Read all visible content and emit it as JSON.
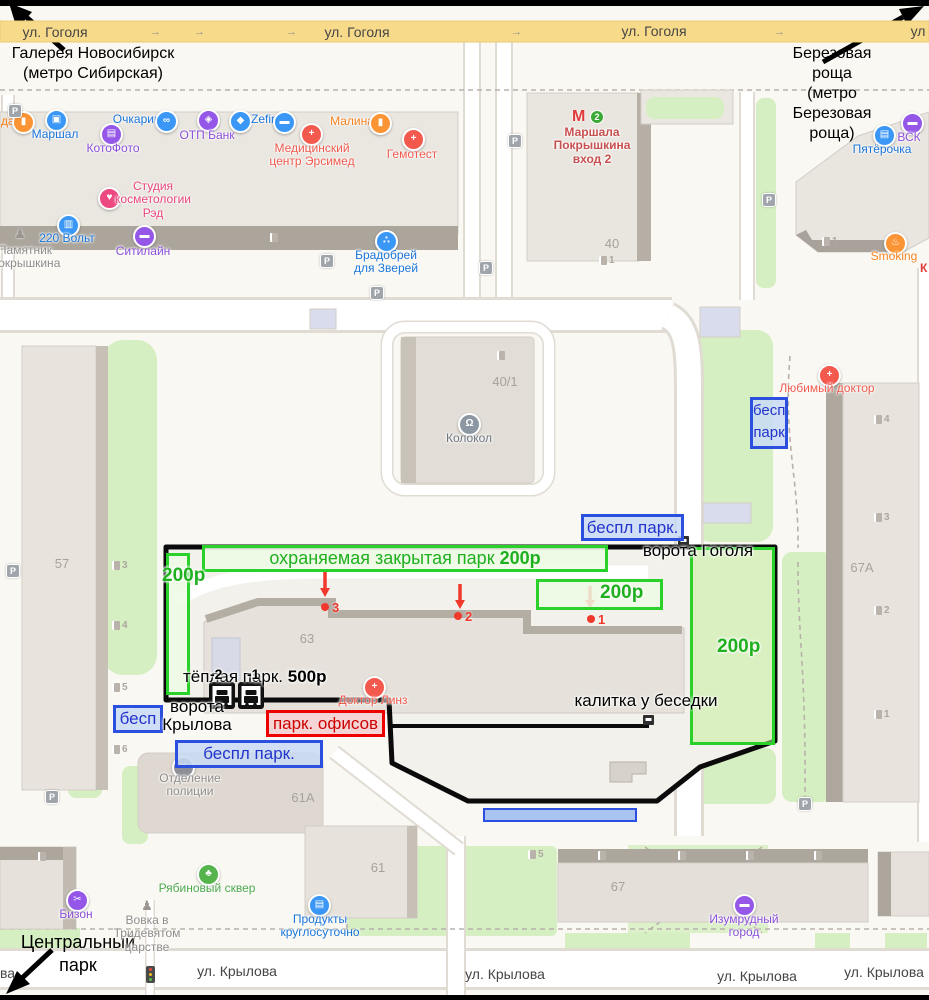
{
  "nav": {
    "top_left": "Галерея Новосибирск\n(метро Сибирская)",
    "top_right": "Березовая роща\n(метро Березовая роща)",
    "bottom_left": "Центральный\nпарк"
  },
  "streets": {
    "gogolya": "ул. Гоголя",
    "gogolya_short": "ул",
    "krylova": "ул. Крылова",
    "krylova_frag": "ва",
    "arrow": "→"
  },
  "parking": {
    "guarded_label": "охраняемая закрытая парк ",
    "guarded_price": "200р",
    "p200": "200р",
    "warm_label": "тёплая парк. ",
    "warm_price": "500р",
    "level_minus2": "-2",
    "level_minus1": "-1",
    "free_short": "бесп",
    "free_two": "бесп\nпарк",
    "free_full": "беспл парк.",
    "office": "парк. офисов"
  },
  "gates": {
    "gogolya": "ворота Гоголя",
    "krylova": "ворота\nКрылова",
    "wicket": "калитка у беседки"
  },
  "markers": {
    "m1": "1",
    "m2": "2",
    "m3": "3"
  },
  "entr": {
    "n1": "1",
    "n2": "2",
    "n3": "3",
    "n4": "4",
    "n5": "5",
    "n6": "6"
  },
  "glyph_p": "P",
  "buildings": {
    "b57": "57",
    "b67a": "67А",
    "b40": "40",
    "b40_1": "40/1",
    "b63": "63",
    "b61a": "61А",
    "b61": "61",
    "b67": "67"
  },
  "metro": {
    "m": "М",
    "line": "2"
  },
  "colors": {
    "annotation_green": "#2BD12B",
    "annotation_blue": "#2B50E0",
    "annotation_red": "#EE0000",
    "road_yellow": "#F8DB8A",
    "map_green": "#D5EFC2"
  },
  "pois": [
    {
      "label": "да",
      "glyph": "▮"
    },
    {
      "label": "Маршал",
      "glyph": "▣"
    },
    {
      "label": "Очкарик",
      "glyph": "∞"
    },
    {
      "label": "КотоФото",
      "glyph": "▤"
    },
    {
      "label": "ОТП Банк",
      "glyph": "◈"
    },
    {
      "label": "Zefir",
      "glyph": "◆"
    },
    {
      "label": "",
      "glyph": "▬"
    },
    {
      "label": "Медицинский\nцентр Эрсимед",
      "glyph": "+"
    },
    {
      "label": "Малина",
      "glyph": "▮"
    },
    {
      "label": "Гемотест",
      "glyph": "+"
    },
    {
      "label": "Студия\nкосметологии\nРэд",
      "glyph": "♥"
    },
    {
      "label": "220 Вольт",
      "glyph": "▥"
    },
    {
      "label": "Памятник\nПокрышкина",
      "glyph": "♟"
    },
    {
      "label": "Ситилайн",
      "glyph": "▬"
    },
    {
      "label": "Брадобрей\nдля Зверей",
      "glyph": "∴"
    },
    {
      "label": "Маршала\nПокрышкина\nвход 2",
      "glyph": ""
    },
    {
      "label": "Пятёрочка",
      "glyph": "▤"
    },
    {
      "label": "ВСК",
      "glyph": "▬"
    },
    {
      "label": "Smoking",
      "glyph": "♨"
    },
    {
      "label": "К",
      "glyph": ""
    },
    {
      "label": "Любимый доктор",
      "glyph": "+"
    },
    {
      "label": "Колокол",
      "glyph": "Ω"
    },
    {
      "label": "Доктор Линз",
      "glyph": "+"
    },
    {
      "label": "Отделение\nполиции",
      "glyph": "×"
    },
    {
      "label": "Бизон",
      "glyph": "✂"
    },
    {
      "label": "Вовка в\nТридевятом\nцарстве",
      "glyph": "♟"
    },
    {
      "label": "Рябиновый сквер",
      "glyph": "♣"
    },
    {
      "label": "Продукты\nкруглосуточно",
      "glyph": "▤"
    },
    {
      "label": "Изумрудный\nгород",
      "glyph": "▬"
    }
  ]
}
